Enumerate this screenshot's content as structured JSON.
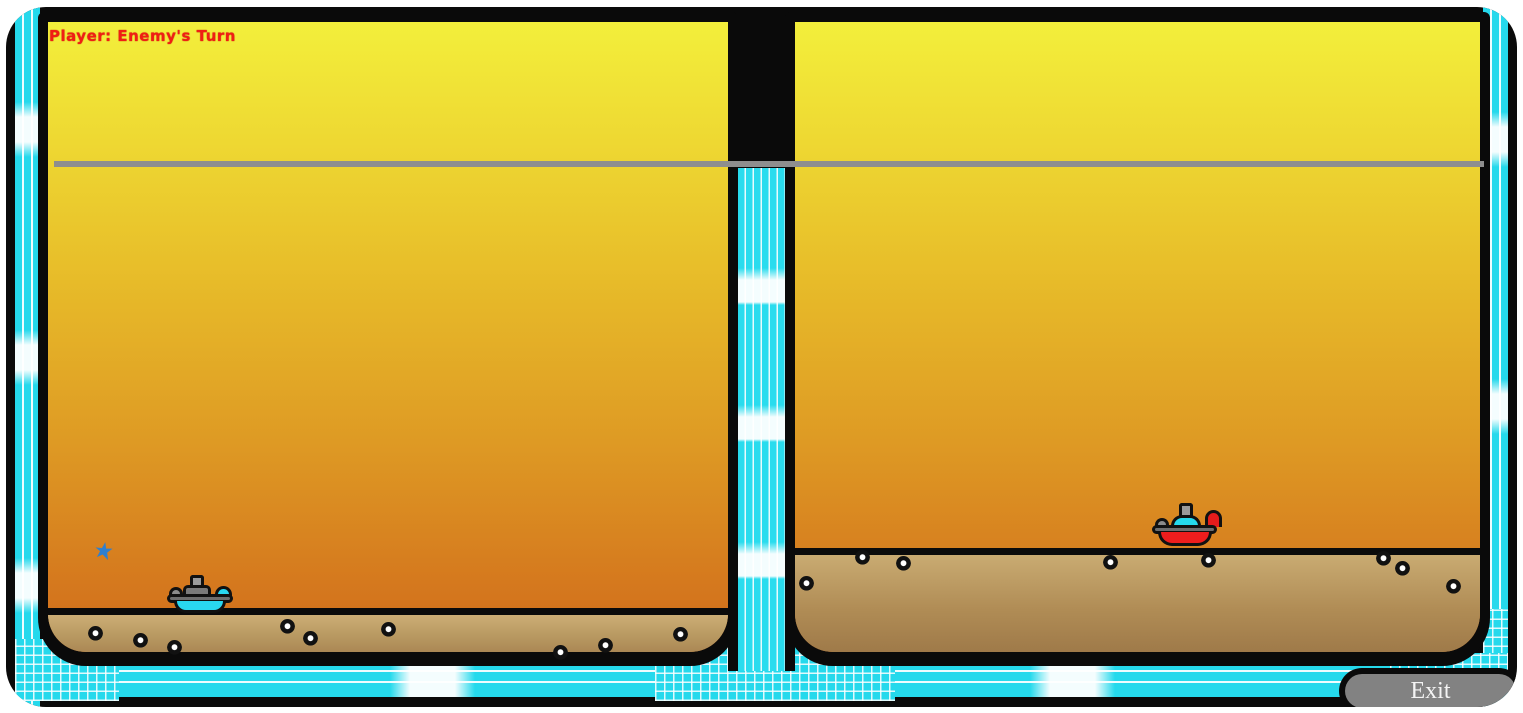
{
  "hud": {
    "turn_indicator": "Player: Enemy's Turn",
    "text_color": "#f01e14"
  },
  "exit_button": {
    "label": "Exit",
    "fill": "#828282"
  },
  "palette": {
    "border_cyan": "#25d9ec",
    "frame_black": "#0a0a0a",
    "sky_top": "#f3ef3b",
    "sky_bottom": "#d06c1a",
    "terrain_light": "#ccae76",
    "terrain_dark": "#9c7747",
    "horizon_line": "#8e8e8e"
  },
  "entities": {
    "player_tank": {
      "label": "player tank",
      "hull_color": "#29d7f0",
      "x": 167,
      "y": 575
    },
    "enemy_tank": {
      "label": "enemy tank",
      "hull_color": "#ee1d1d",
      "x": 1152,
      "y": 503
    },
    "splat": {
      "label": "impact splat",
      "color": "#2e7fd0",
      "x": 95,
      "y": 542
    }
  },
  "craters": [
    [
      95,
      633
    ],
    [
      140,
      640
    ],
    [
      174,
      647
    ],
    [
      287,
      626
    ],
    [
      310,
      638
    ],
    [
      388,
      629
    ],
    [
      560,
      652
    ],
    [
      605,
      645
    ],
    [
      680,
      634
    ],
    [
      806,
      583
    ],
    [
      862,
      557
    ],
    [
      903,
      563
    ],
    [
      1110,
      562
    ],
    [
      1208,
      560
    ],
    [
      1383,
      558
    ],
    [
      1402,
      568
    ],
    [
      1453,
      586
    ]
  ]
}
